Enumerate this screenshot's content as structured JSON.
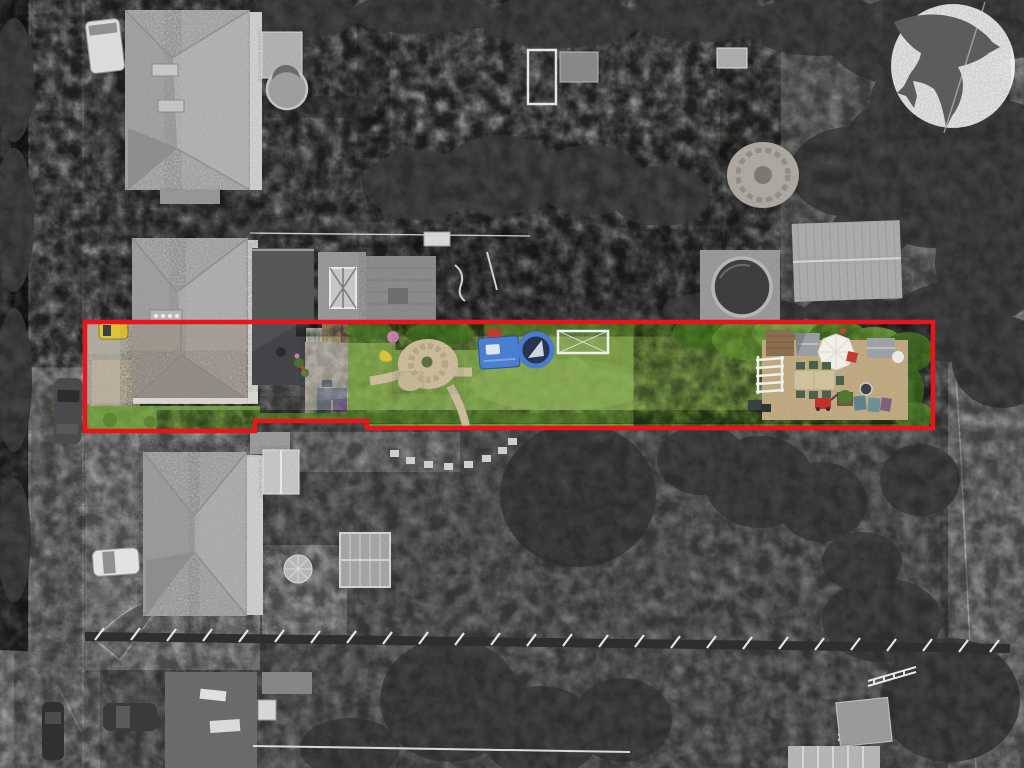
{
  "scene": {
    "type": "aerial-drone-photograph",
    "treatment": "black-and-white aerial photo with the marketed plot highlighted in full colour",
    "subject": "long narrow rear garden and house plot outlined in red, neighbouring houses, road at left, gardens and trees around",
    "boundary": {
      "color": "#e8151b",
      "stroke_px": 4.5,
      "path": "M85 322 H933 V428 H367 V421 H255 V431 H85 Z"
    },
    "logo": {
      "name": "swallow-bird-emblem",
      "circle_color": "#ffffff",
      "circle_opacity": "0.87"
    },
    "palette": {
      "road_gray": "#9a9a9a",
      "pavement_gray": "#a5a5a5",
      "roof_gray": "#b0b0b0",
      "plot_roof_warm": "#a8a29a",
      "extension_roof_dark": "#46474c",
      "lawn_green": "#84a851",
      "hedge_green": "#5f8635",
      "bright_hedge_green": "#7aa44a",
      "gravel_tan": "#c3ad85",
      "stone_circle_tan": "#cdbf9f",
      "pool_ring_blue": "#4d79d2",
      "pool_water": "#26344e",
      "table_blue": "#4a7ed3",
      "goal_white": "#f0f0f0",
      "parasol_white": "#f1efe8",
      "mower_red": "#c23128",
      "car_yellow": "#e3c238",
      "tree_dark_gray": "#454545",
      "fence_dark": "#2e2e2e"
    }
  }
}
